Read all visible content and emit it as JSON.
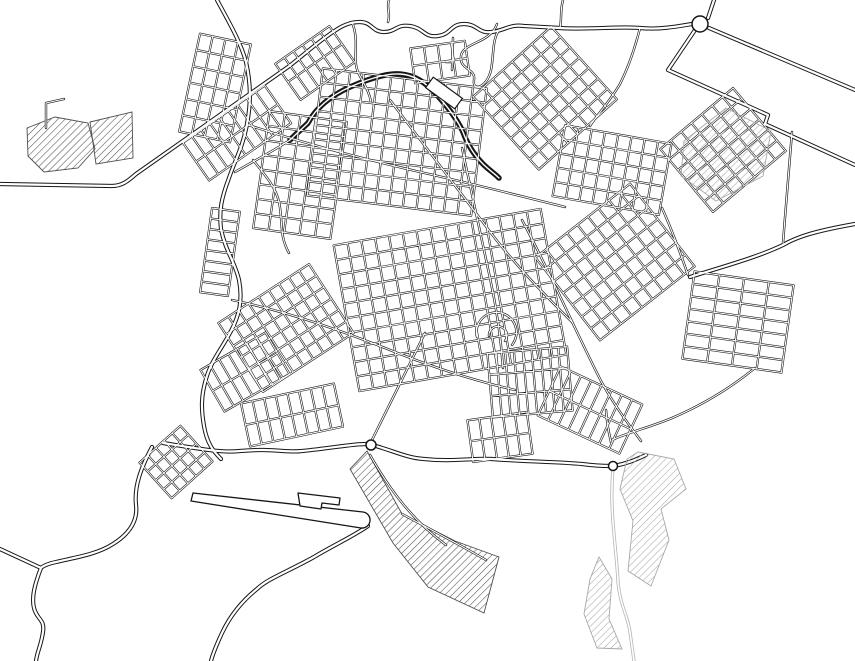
{
  "map": {
    "width": 855,
    "height": 661,
    "colors": {
      "background": "#ffffff",
      "road_casing": "#161616",
      "road_fill": "#ffffff",
      "light_road": "#b5b5b5",
      "hatch_dark": "#4f4f4f",
      "hatch_light": "#a8a8a8"
    },
    "highways": [
      "M0,184 L112,186 C122,186 128,181 136,174 L288,67 C300,58 320,40 336,30 C345,24 352,22 360,22 C372,22 372,32 384,32 C396,32 396,24 410,26 C424,28 424,38 438,36 C452,34 450,24 464,24 C478,24 478,34 492,32 C506,30 510,24 524,26 L560,28 C590,30 620,26 640,28 C660,30 680,26 692,24",
      "M708,18 L714,0",
      "M709,28 L855,90",
      "M695,30 C685,45 676,58 668,70 M668,70 L768,115 L765,124 L855,165",
      "M855,224 C810,232 795,238 783,245 C758,257 725,266 690,277",
      "M217,0 C229,22 241,43 246,62 C251,84 251,103 247,124 C243,147 235,160 229,178 C221,199 219,211 221,229 C225,250 235,262 239,280 C243,300 239,316 231,331 C221,350 211,361 206,379 C201,396 201,409 204,426 C207,444 214,452 221,459",
      "M152,447 C141,468 134,486 136,505 C138,521 129,534 113,544 C96,555 72,558 56,562 C47,564 43,566 41,568 M41,568 L0,549 M41,568 C36,581 31,596 34,608 C37,620 45,619 43,632 C41,646 37,652 36,661",
      "M368,526 C352,537 332,546 314,557 C287,572 267,579 257,589 C242,601 230,616 222,633 C216,646 213,653 211,661",
      "M163,443 C200,449 222,453 240,451 C272,448 287,453 302,451 C332,448 352,444 366,444 M376,446 C396,452 408,458 424,459 C452,462 472,458 492,459 C532,462 562,462 582,464 C597,466 606,466 611,466 M614,466 C630,463 639,458 646,455"
    ],
    "racetrack": [
      "M290,140 C298,132 303,128 308,123 C316,108 330,96 350,87 C366,80 386,73 400,74 C415,75 426,83 436,94 C448,107 457,119 463,132 C467,143 474,155 483,164 C489,170 494,173 499,178"
    ],
    "streets": [
      "M248,125 C310,145 360,158 420,172 C470,183 520,196 565,207",
      "M390,100 C420,140 455,185 485,225 C512,262 542,292 572,322",
      "M232,300 C290,312 345,332 395,352 C440,370 480,382 515,390",
      "M462,148 C472,195 482,240 490,278 C497,310 501,340 503,368",
      "M425,333 L369,446",
      "M522,220 C548,268 575,330 601,381 C613,403 626,421 641,441",
      "M352,22 C360,42 352,58 358,72 C363,83 369,90 371,102",
      "M640,28 C634,52 628,68 620,84 C608,104 596,116 590,126",
      "M792,132 C789,165 786,205 783,243",
      "M755,368 C728,390 700,406 672,418 C648,428 626,433 612,440",
      "M253,160 C266,176 276,188 279,202 C283,220 279,236 289,253",
      "M497,24 C490,44 463,42 461,56 C459,70 476,68 474,80 C472,92 487,88 491,70 C494,55 492,40 499,30",
      "M453,38 L452,70",
      "M446,62 L452,62",
      "M606,410 C607,424 609,434 611,442",
      "M46,128 L46,103 L64,99",
      "M662,208 C672,230 680,252 688,275",
      "M389,0 C386,8 391,14 388,22",
      "M563,0 C560,10 562,18 560,28",
      "M370,455 C390,490 412,520 446,545",
      "M402,514 C432,530 460,545 486,560",
      "M477,337 A20,20 0 1 1 512,345",
      "M489,336 A9,9 0 1 1 505,341",
      "M235,172 C252,162 270,153 290,140"
    ],
    "light_roads": [
      "M613,468 C611,492 612,508 613,522 C615,548 617,562 618,582 C620,606 628,616 630,632 C632,647 633,654 634,661"
    ],
    "grids": [
      {
        "cx": 215,
        "cy": 88,
        "w": 52,
        "h": 100,
        "angle": 12,
        "nx": 5,
        "ny": 7
      },
      {
        "cx": 237,
        "cy": 133,
        "w": 100,
        "h": 46,
        "angle": -35,
        "nx": 10,
        "ny": 3
      },
      {
        "cx": 220,
        "cy": 252,
        "w": 28,
        "h": 85,
        "angle": 8,
        "nx": 2,
        "ny": 9
      },
      {
        "cx": 300,
        "cy": 175,
        "w": 78,
        "h": 118,
        "angle": 8,
        "nx": 6,
        "ny": 9
      },
      {
        "cx": 397,
        "cy": 142,
        "w": 165,
        "h": 128,
        "angle": 7,
        "nx": 13,
        "ny": 10
      },
      {
        "cx": 315,
        "cy": 63,
        "w": 66,
        "h": 44,
        "angle": -35,
        "nx": 7,
        "ny": 3
      },
      {
        "cx": 545,
        "cy": 98,
        "w": 105,
        "h": 98,
        "angle": -42,
        "nx": 9,
        "ny": 8
      },
      {
        "cx": 612,
        "cy": 170,
        "w": 108,
        "h": 72,
        "angle": 10,
        "nx": 9,
        "ny": 6
      },
      {
        "cx": 723,
        "cy": 150,
        "w": 95,
        "h": 82,
        "angle": -40,
        "nx": 8,
        "ny": 7
      },
      {
        "cx": 286,
        "cy": 328,
        "w": 108,
        "h": 82,
        "angle": -33,
        "nx": 10,
        "ny": 7
      },
      {
        "cx": 450,
        "cy": 300,
        "w": 210,
        "h": 148,
        "angle": -10,
        "nx": 16,
        "ny": 11
      },
      {
        "cx": 615,
        "cy": 262,
        "w": 120,
        "h": 105,
        "angle": -38,
        "nx": 10,
        "ny": 8
      },
      {
        "cx": 738,
        "cy": 322,
        "w": 100,
        "h": 88,
        "angle": 8,
        "nx": 5,
        "ny": 8
      },
      {
        "cx": 245,
        "cy": 372,
        "w": 75,
        "h": 48,
        "angle": -30,
        "nx": 8,
        "ny": 3
      },
      {
        "cx": 292,
        "cy": 415,
        "w": 95,
        "h": 44,
        "angle": -12,
        "nx": 9,
        "ny": 3
      },
      {
        "cx": 530,
        "cy": 382,
        "w": 80,
        "h": 64,
        "angle": -5,
        "nx": 10,
        "ny": 4
      },
      {
        "cx": 590,
        "cy": 410,
        "w": 90,
        "h": 54,
        "angle": 25,
        "nx": 9,
        "ny": 3
      },
      {
        "cx": 500,
        "cy": 437,
        "w": 60,
        "h": 42,
        "angle": -8,
        "nx": 6,
        "ny": 3
      },
      {
        "cx": 176,
        "cy": 462,
        "w": 55,
        "h": 48,
        "angle": -42,
        "nx": 6,
        "ny": 5
      },
      {
        "cx": 440,
        "cy": 62,
        "w": 55,
        "h": 35,
        "angle": -8,
        "nx": 5,
        "ny": 3
      }
    ],
    "hatches_under": [
      {
        "path": "M27,128 L55,117 L88,123 L95,149 L78,168 L44,172 L28,156 Z"
      },
      {
        "path": "M90,122 L132,112 L133,158 L96,164 Z"
      },
      {
        "path": "M367,451 L402,514 L455,541 L499,557 L484,613 L428,587 L393,543 L350,469 Z"
      }
    ],
    "hatches_over": [
      {
        "path": "M684,141 L726,108 L771,131 L763,176 L716,201 L681,176 Z"
      },
      {
        "path": "M638,452 L674,459 L686,489 L661,509 L669,540 L651,586 L628,571 L633,521 L620,489 L627,459 Z"
      },
      {
        "path": "M599,557 L612,579 L609,619 L622,649 L597,648 L584,614 L590,579 Z"
      }
    ],
    "runway": [
      "M193,493 L363,512 A7.5,7.5 0 1 1 361,528 L191,501 Z",
      "M298,493 L340,498 L339,505 L322,503 L321,509 L300,506 Z"
    ],
    "blocks": [
      {
        "cx": 444,
        "cy": 93,
        "w": 13,
        "h": 36,
        "angle": -54
      }
    ],
    "roundabouts": [
      {
        "cx": 700,
        "cy": 24,
        "r": 8
      },
      {
        "cx": 371,
        "cy": 445,
        "r": 5
      },
      {
        "cx": 613,
        "cy": 466,
        "r": 4.5
      }
    ]
  }
}
